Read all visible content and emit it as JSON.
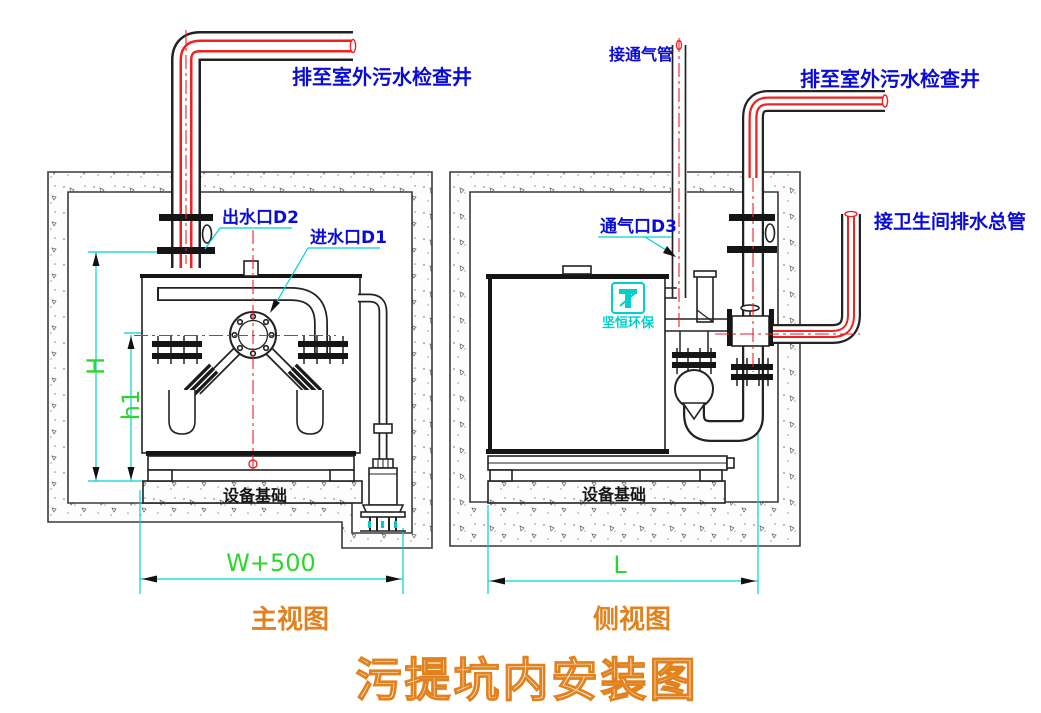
{
  "drawing": {
    "title": "污提坑内安装图",
    "logo_text": "坚恒环保",
    "front_view": {
      "caption": "主视图",
      "labels": {
        "discharge": "排至室外污水检查井",
        "outlet": "出水口D2",
        "inlet": "进水口D1",
        "foundation": "设备基础"
      },
      "dimensions": {
        "height_total": "H",
        "height_inlet": "h1",
        "width": "W+500"
      }
    },
    "side_view": {
      "caption": "侧视图",
      "labels": {
        "vent_connect": "接通气管",
        "discharge": "排至室外污水检查井",
        "vent_port": "通气口D3",
        "toilet_main": "接卫生间排水总管",
        "foundation": "设备基础"
      },
      "dimensions": {
        "length": "L"
      }
    },
    "colors": {
      "label_blue": "#0b0bd6",
      "dimension_green": "#2fd52f",
      "leader_cyan": "#00d2d2",
      "centerline_red": "#ee2222",
      "caption_orange": "#e2821e",
      "line_dark": "#222222"
    }
  }
}
